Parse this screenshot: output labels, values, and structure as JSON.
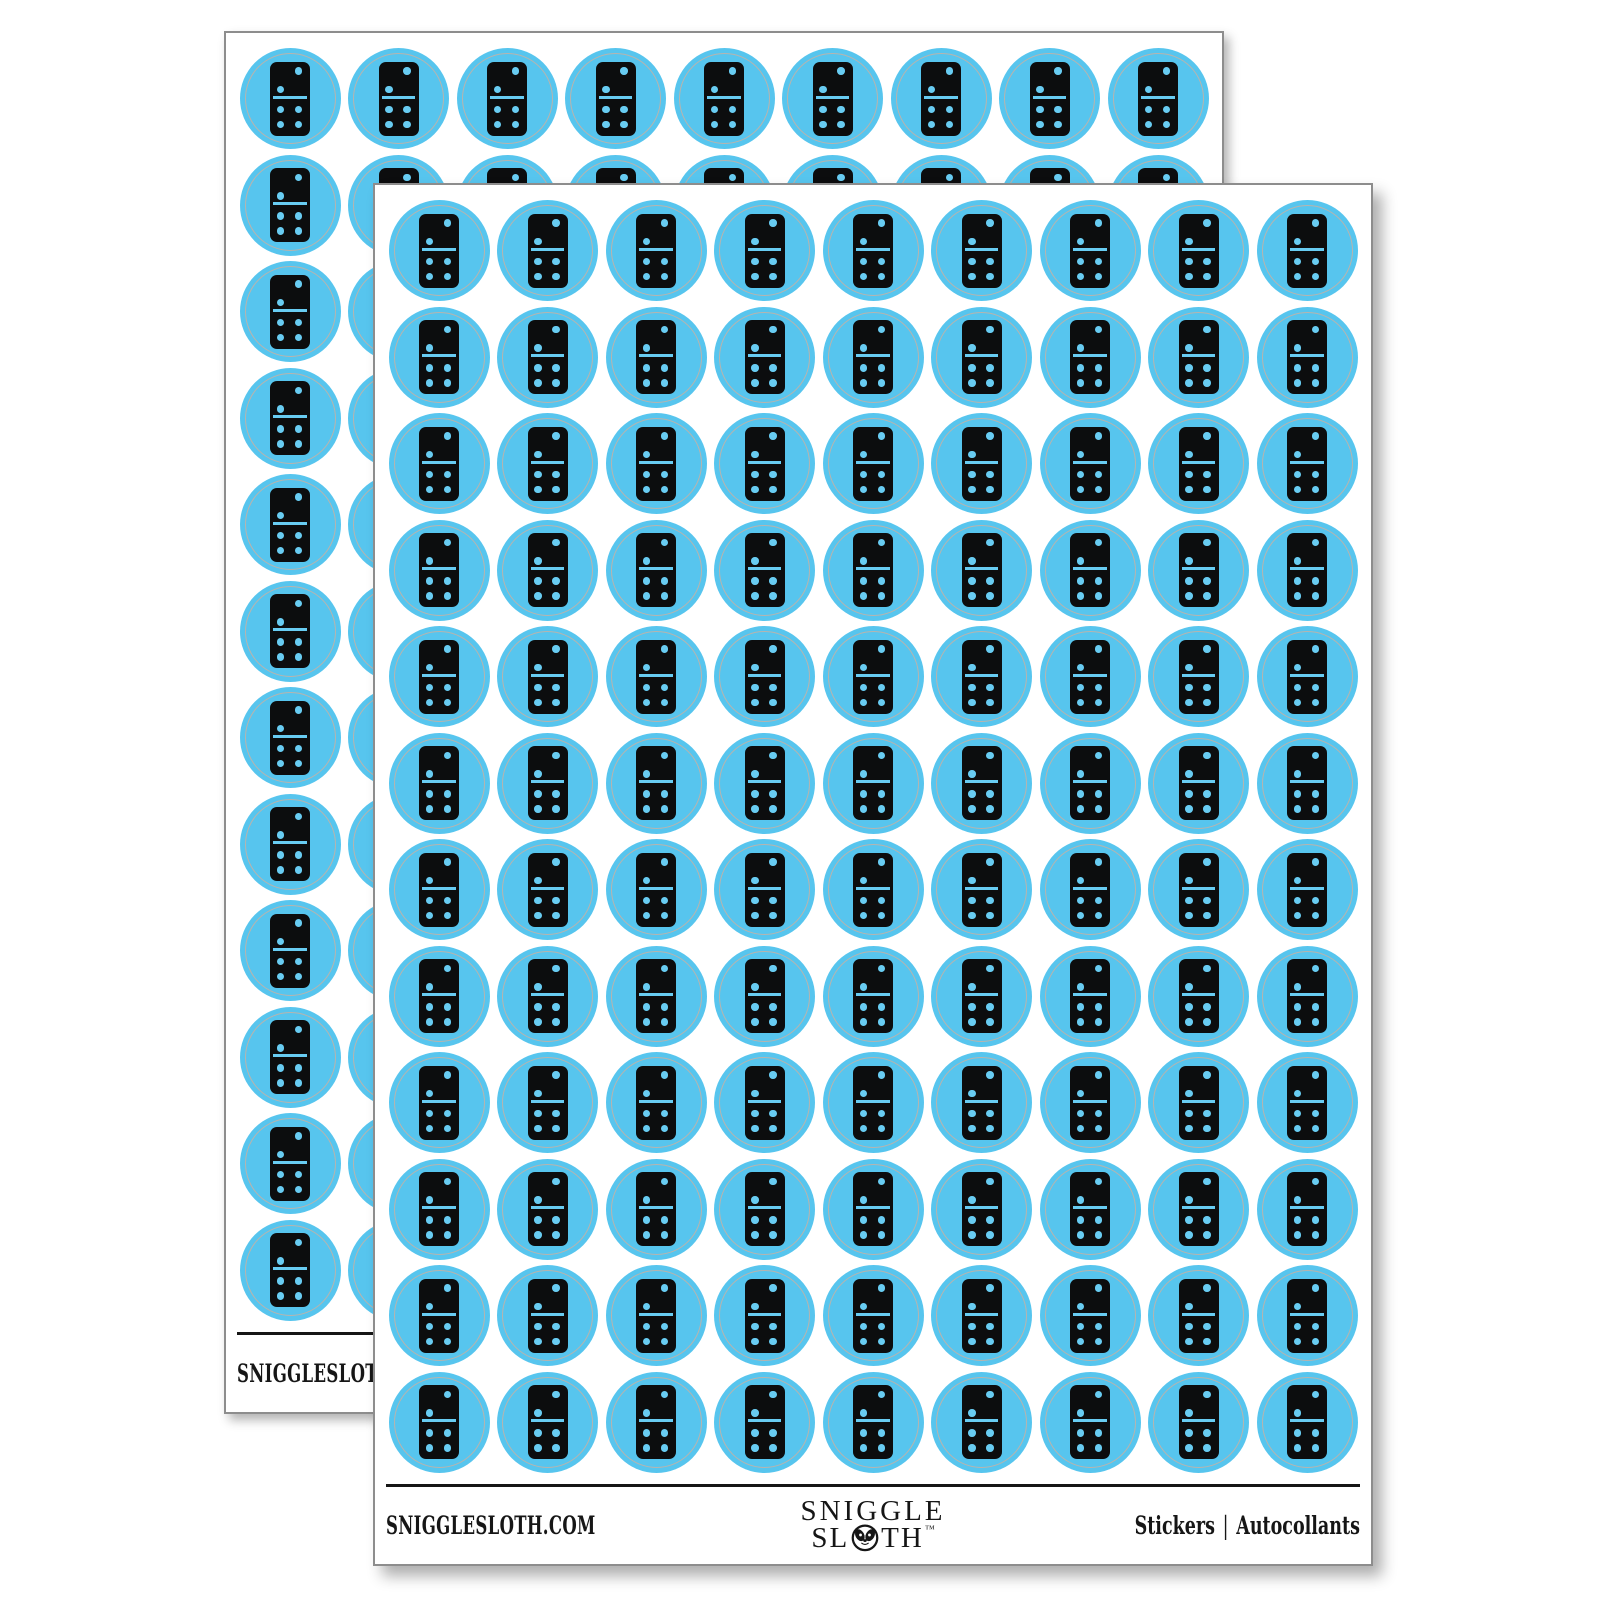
{
  "image_type": "sticker-sheet-product-mockup",
  "background_color": "#ffffff",
  "sheets": [
    {
      "id": "back-sheet"
    },
    {
      "id": "front-sheet"
    }
  ],
  "sheet": {
    "grid": {
      "rows": 12,
      "cols": 9,
      "stickers_per_sheet": 108
    },
    "sticker": {
      "shape": "circle",
      "fill_color": "#57c5ee",
      "pip_color": "#68ccf2",
      "tile_color": "#0c0d0e",
      "die_cut_ring_color": "#b8b4ae",
      "icon": "domino-tile-2-4",
      "domino_top_pips": 2,
      "domino_bottom_pips": 4
    },
    "footer": {
      "left_text": "SNIGGLESLOTH.COM",
      "brand": {
        "line1": "SNIGGLE",
        "line2_prefix": "SL",
        "line2_suffix": "TH",
        "trademark": "™",
        "icon": "sloth-face-icon"
      },
      "right": {
        "label_en": "Stickers",
        "separator": "|",
        "label_fr": "Autocollants"
      }
    }
  }
}
